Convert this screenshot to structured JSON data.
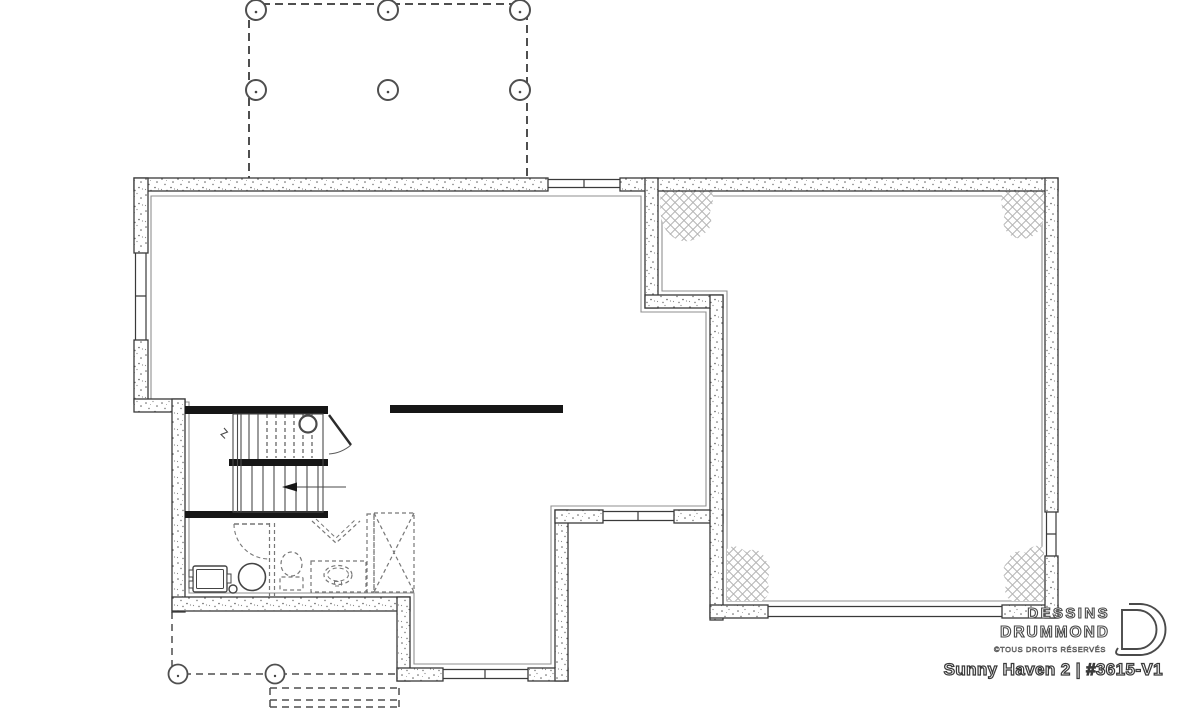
{
  "branding": {
    "logo_line1": "DESSINS",
    "logo_line2": "DRUMMOND",
    "copyright": "©TOUS DROITS RÉSERVÉS",
    "plan_title": "Sunny Haven 2 | #3615-V1"
  },
  "colors": {
    "background": "#ffffff",
    "linework": "#3a3a3a",
    "inner_line": "#8f8f8f",
    "framing_wall_fill": "#161616",
    "hatch": "#b5b5b5",
    "dashed_future": "#777777"
  },
  "plan": {
    "level": "foundation-basement",
    "deck_post_count": 6,
    "porch_post_count": 2,
    "has_garage_door_opening": true,
    "fixtures": [
      "stairs",
      "stair-direction-arrow",
      "landing-post",
      "furnace",
      "floor-drain",
      "water-heater",
      "future-toilet",
      "future-vanity-sink",
      "future-shower",
      "steel-beam",
      "future-door",
      "bifold-doors"
    ]
  }
}
